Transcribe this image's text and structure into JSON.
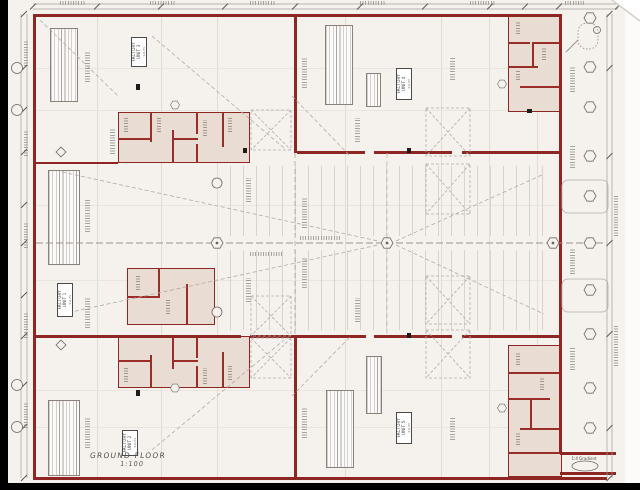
{
  "drawing": {
    "title": "GROUND FLOOR",
    "scale": "1:100",
    "ramp_label": "1:4 Gradient",
    "units": [
      {
        "line1": "FACTORY",
        "line2": "UNIT 3",
        "area": "sq.m"
      },
      {
        "line1": "FACTORY",
        "line2": "UNIT 4",
        "area": "sq.m"
      },
      {
        "line1": "FACTORY",
        "line2": "UNIT 1",
        "area": "sq.m"
      },
      {
        "line1": "FACTORY",
        "line2": "UNIT 2",
        "area": "sq.m"
      },
      {
        "line1": "FACTORY",
        "line2": "UNIT 5",
        "area": "sq.m"
      }
    ],
    "colors": {
      "wall": "#8e2623",
      "office_fill": "#e9dcd3",
      "sheet": "#f5f2ee",
      "frame": "#000000",
      "dimension_line": "#a79e99"
    }
  }
}
